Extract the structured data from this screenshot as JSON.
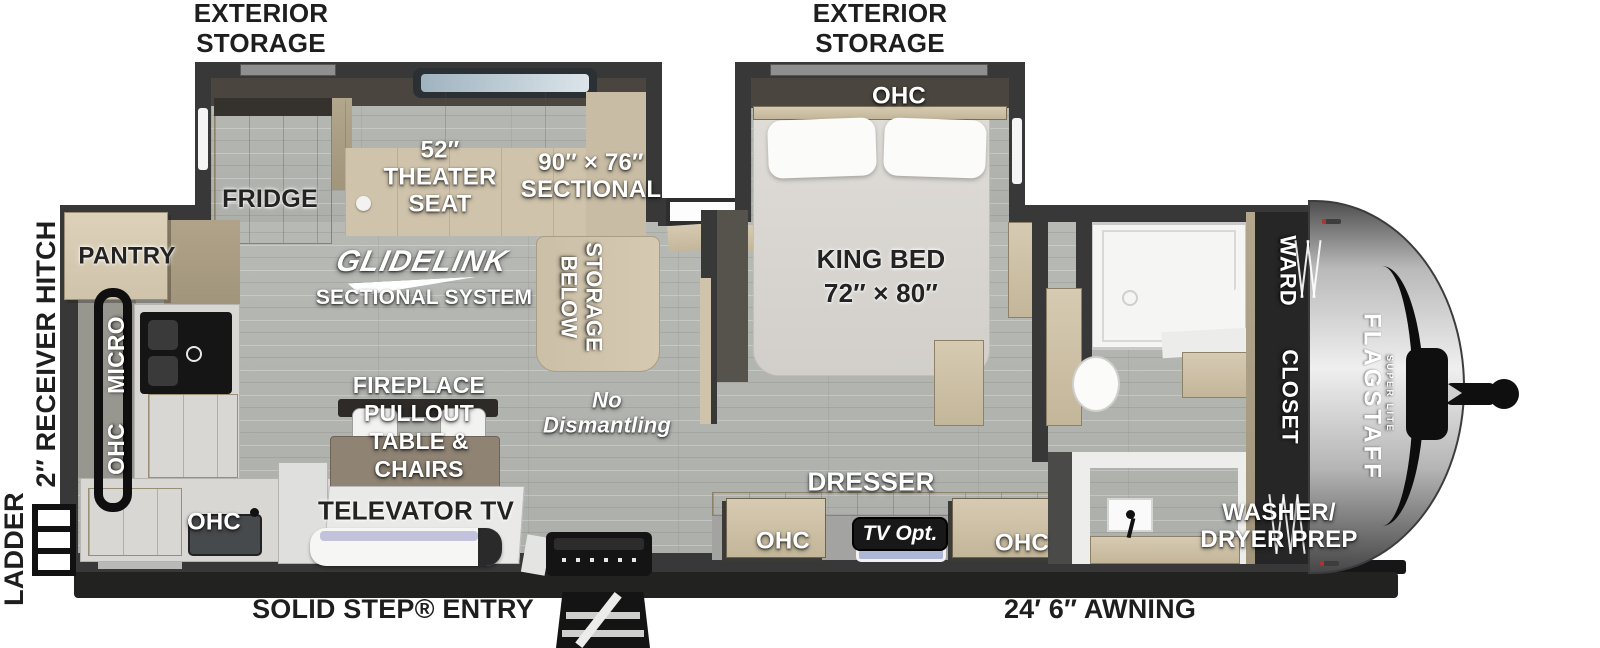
{
  "colors": {
    "wall": "#383838",
    "floor": "#b4b6b2",
    "wood": "#cfc3aa",
    "sofa": "#cbbfa7",
    "chassis": "#1d1d1d",
    "cap_silver": "#c7c7c7",
    "label_dark": "#222222",
    "label_light": "#ffffff",
    "badge_dark": "#181818",
    "skylight_blue": "#bdc9d2",
    "tv_screen": "#aeb6d6"
  },
  "floorplan": {
    "exterior": {
      "storage_label": "EXTERIOR\nSTORAGE",
      "ladder": "LADDER",
      "receiver_hitch": "2″ RECEIVER HITCH",
      "solid_step_entry": "SOLID STEP® ENTRY",
      "awning": "24′ 6″ AWNING",
      "brand": "FLAGSTAFF",
      "brand_sub": "SUPER LITE"
    },
    "living": {
      "fridge": "FRIDGE",
      "pantry": "PANTRY",
      "theater_seat": "52″\nTHEATER\nSEAT",
      "sectional": "90″ × 76″\nSECTIONAL",
      "storage_below": "STORAGE\nBELOW",
      "glidelink": "GLIDELINK",
      "glidelink_sub": "SECTIONAL SYSTEM",
      "fireplace": "FIREPLACE\nPULLOUT\nTABLE &\nCHAIRS",
      "televator_tv": "TELEVATOR TV",
      "no_dismantling": "No\nDismantling"
    },
    "kitchen": {
      "micro": "MICRO",
      "ohc": "OHC"
    },
    "bedroom": {
      "ohc": "OHC",
      "king_bed": "KING BED\n72″ × 80″",
      "dresser": "DRESSER",
      "tv_opt": "TV Opt."
    },
    "bath": {
      "ward": "WARD",
      "closet": "CLOSET",
      "washer_dryer_prep": "WASHER/\nDRYER PREP"
    }
  }
}
